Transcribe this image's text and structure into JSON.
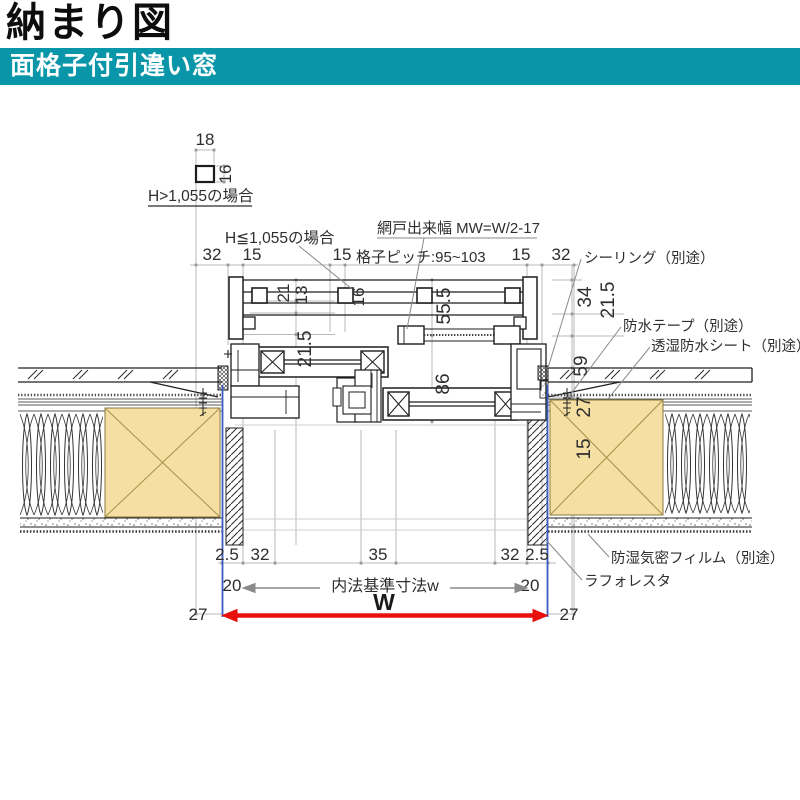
{
  "header": {
    "title": "納まり図",
    "subtitle": "面格子付引違い窓"
  },
  "colors": {
    "accent_teal": "#0996a9",
    "wood_fill": "#f5dfa2",
    "arrow_red": "#e8100c",
    "extension_blue": "#3b5bc0"
  },
  "detail_callout": {
    "width": "18",
    "height": "16",
    "label": "H>1,055の場合"
  },
  "annotations": {
    "case_le": "H≦1,055の場合",
    "screen_width": "網戸出来幅 MW=W/2-17",
    "grille_pitch": "格子ピッチ:95~103",
    "sealing": "シーリング（別途）",
    "waterproof_tape": "防水テープ（別途）",
    "breathable_sheet": "透湿防水シート（別途）",
    "moisture_film": "防湿気密フィルム（別途）",
    "laforesta": "ラフォレスタ"
  },
  "dims": {
    "top_row": {
      "d32_left": "32",
      "d15_left": "15",
      "d15_mid": "15",
      "d15_right": "15",
      "d32_right": "32"
    },
    "left_stack": {
      "d21": "21",
      "d13": "13",
      "d16": "16",
      "d21_5": "21.5",
      "d55_5": "55.5",
      "d86": "86"
    },
    "right_stack": {
      "d34": "34",
      "d21_5": "21.5",
      "d59": "59",
      "d27": "27",
      "d15": "15"
    },
    "bottom_row1": {
      "d2_5_left": "2.5",
      "d32_left": "32",
      "d35": "35",
      "d32_right": "32",
      "d2_5_right": "2.5"
    },
    "bottom_row2": {
      "d20_left": "20",
      "label": "内法基準寸法w",
      "d20_right": "20"
    },
    "bottom_row3": {
      "d27_left": "27",
      "w": "W",
      "d27_right": "27"
    }
  }
}
